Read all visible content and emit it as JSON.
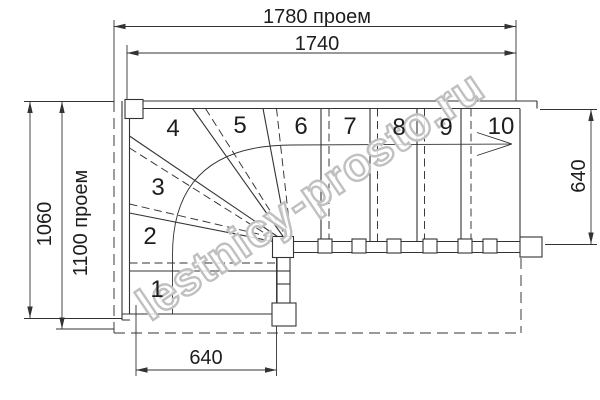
{
  "watermark": "lestnicy-prosto.ru",
  "dimensions": {
    "top_opening": "1780 проем",
    "top_inner": "1740",
    "left_height": "1060",
    "left_opening": "1100 проем",
    "right_width": "640",
    "bottom_width": "640"
  },
  "steps": [
    "1",
    "2",
    "3",
    "4",
    "5",
    "6",
    "7",
    "8",
    "9",
    "10"
  ],
  "colors": {
    "line": "#333333",
    "watermark": "#c0c0c0",
    "background": "#ffffff"
  }
}
